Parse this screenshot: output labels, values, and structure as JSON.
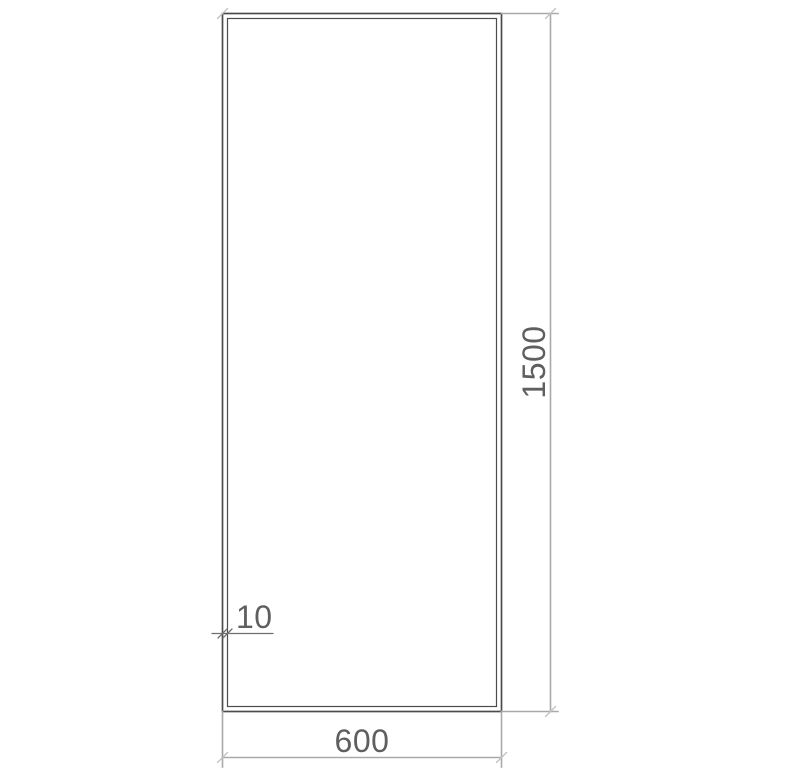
{
  "drawing": {
    "dimensions": {
      "width": {
        "value": "600"
      },
      "height": {
        "value": "1500"
      },
      "edge_thickness": {
        "value": "10"
      }
    },
    "colors": {
      "background": "#ffffff",
      "object_line": "#4c4c4c",
      "inner_line": "#3f3f3f",
      "dimension_line": "#a9a9a9",
      "tick": "#c3c3c3",
      "leader_line": "#6f6f6f",
      "text": "#5f5f5f"
    }
  }
}
